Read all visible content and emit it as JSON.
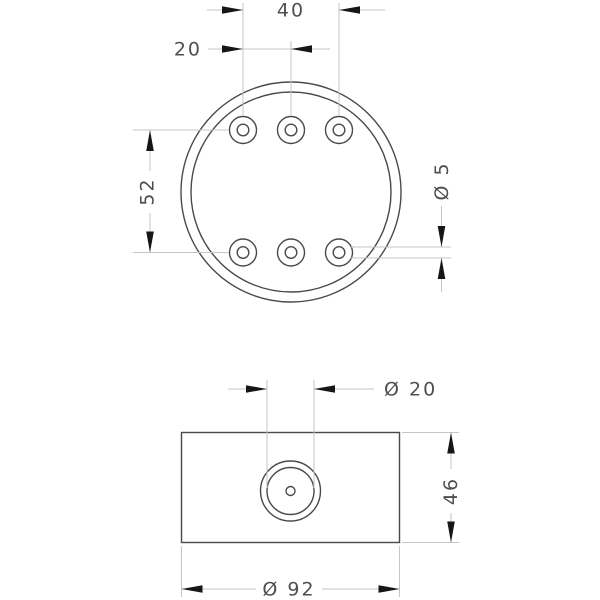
{
  "drawing": {
    "labels": {
      "dim_40": "40",
      "dim_20": "20",
      "dim_52": "52",
      "dia_5": "Ø 5",
      "dia_20": "Ø 20",
      "dim_46": "46",
      "dia_92": "Ø 92"
    },
    "colors": {
      "background": "#ffffff",
      "object_line": "#4a4a4a",
      "dimension_line": "#c6c6c6",
      "arrowhead": "#161616",
      "text": "#4f4f4f"
    }
  }
}
